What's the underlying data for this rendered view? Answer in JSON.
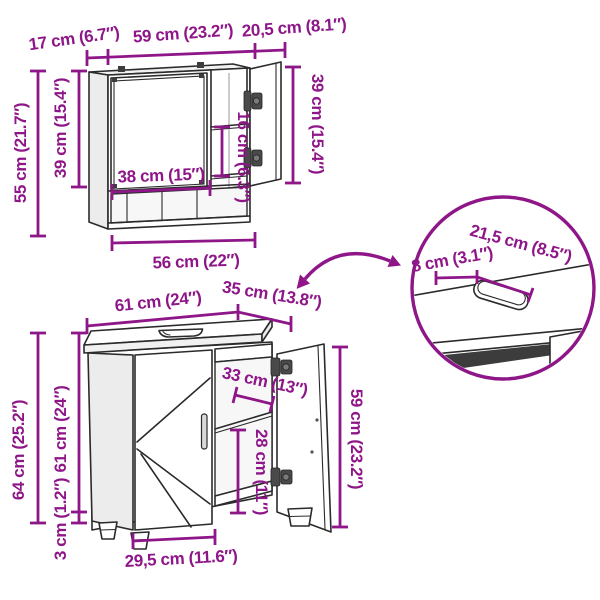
{
  "colors": {
    "dimension_accent": "#8E1688",
    "outline": "#2B2B2B"
  },
  "mirror_cabinet": {
    "depth": "17 cm (6.7″)",
    "width": "59 cm (23.2″)",
    "door_width": "20,5 cm (8.1″)",
    "height": "55 cm (21.7″)",
    "mirror_door_height": "39 cm (15.4″)",
    "side_door_height": "39 cm (15.4″)",
    "shelf_spacing": "16 cm (6.3″)",
    "mirror_door_width": "38 cm (15″)",
    "bottom_width": "56 cm (22″)"
  },
  "vanity_cabinet": {
    "width": "61 cm (24″)",
    "depth": "35 cm (13.8″)",
    "opening_width": "33 cm (13″)",
    "door_height": "59 cm (23.2″)",
    "shelf_clearance": "28 cm (11″)",
    "height": "64 cm (25.2″)",
    "body_height": "61 cm (24″)",
    "feet_height": "3 cm (1.2″)",
    "door_width": "29,5 cm (11.6″)"
  },
  "pipe_cutout_detail": {
    "cutout_width": "21,5 cm (8.5″)",
    "cutout_offset": "8 cm (3.1″)"
  }
}
